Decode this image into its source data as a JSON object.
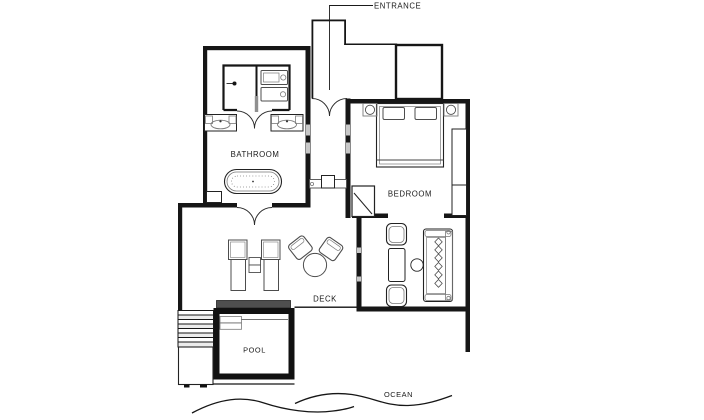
{
  "plan": {
    "title": "villa-floor-plan",
    "labels": {
      "entrance": "ENTRANCE",
      "bathroom": "BATHROOM",
      "bedroom": "BEDROOM",
      "deck": "DECK",
      "pool": "POOL",
      "ocean": "OCEAN"
    },
    "colors": {
      "wall": "#161616",
      "furniture_stroke": "#4d4d4d",
      "window_slot": "#c8c8c8",
      "pool_coping_bar": "#4f4f4f",
      "stair_tread": "#ececec",
      "background": "#ffffff"
    }
  }
}
